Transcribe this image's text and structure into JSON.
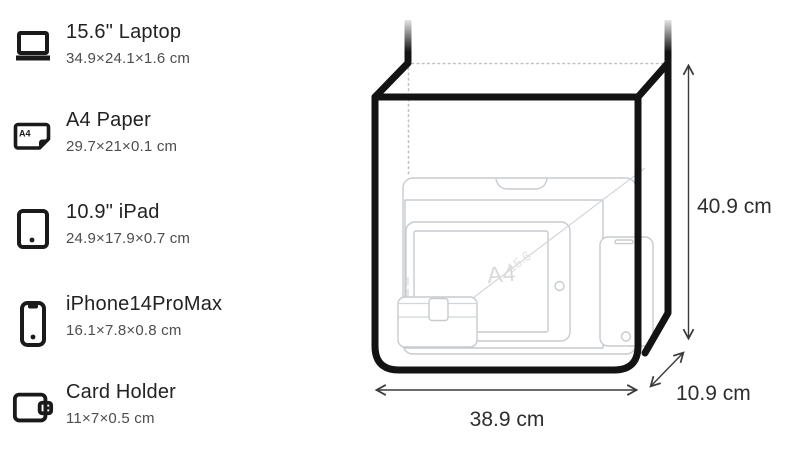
{
  "items": [
    {
      "icon": "laptop-icon",
      "title": "15.6\" Laptop",
      "dims": "34.9×24.1×1.6 cm"
    },
    {
      "icon": "a4-paper-icon",
      "title": "A4 Paper",
      "dims": "29.7×21×0.1 cm"
    },
    {
      "icon": "ipad-icon",
      "title": "10.9\" iPad",
      "dims": "24.9×17.9×0.7 cm"
    },
    {
      "icon": "iphone-icon",
      "title": "iPhone14ProMax",
      "dims": "16.1×7.8×0.8 cm"
    },
    {
      "icon": "card-holder-icon",
      "title": "Card Holder",
      "dims": "11×7×0.5 cm"
    }
  ],
  "bag": {
    "height_label": "40.9 cm",
    "width_label": "38.9 cm",
    "depth_label": "10.9 cm",
    "watermarks": {
      "a4": "A4",
      "laptop_diagonal": "15.6"
    }
  },
  "icon_a4_glyph": "A4",
  "colors": {
    "background": "#ffffff",
    "title_text": "#222222",
    "dims_text": "#4d4d4d",
    "bag_outline": "#131313",
    "ghost_outline": "#c6cbcf",
    "dimension_text": "#2e2e2e"
  }
}
